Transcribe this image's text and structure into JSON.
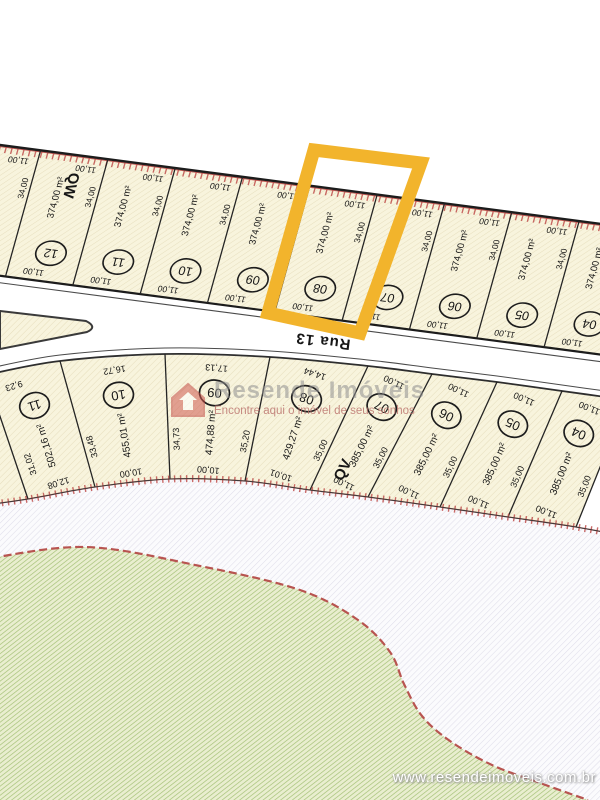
{
  "plan": {
    "street_label": "Rua 13",
    "highlight_color": "#F2B42C",
    "boundary_color": "#C0504D",
    "green_border_color": "#B85450",
    "quadra_top": {
      "label": "QW",
      "lots": [
        {
          "number": "13",
          "area": "374,00 m²",
          "side": "34,00",
          "front_top": "11,00",
          "front_bottom": "11,00",
          "highlighted": false
        },
        {
          "number": "12",
          "area": "374,00 m²",
          "side": "34,00",
          "front_top": "11,00",
          "front_bottom": "11,00",
          "highlighted": false
        },
        {
          "number": "11",
          "area": "374,00 m²",
          "side": "34,00",
          "front_top": "11,00",
          "front_bottom": "11,00",
          "highlighted": false
        },
        {
          "number": "10",
          "area": "374,00 m²",
          "side": "34,00",
          "front_top": "11,00",
          "front_bottom": "11,00",
          "highlighted": false
        },
        {
          "number": "09",
          "area": "374,00 m²",
          "side": "34,00",
          "front_top": "11,00",
          "front_bottom": "11,00",
          "highlighted": false
        },
        {
          "number": "08",
          "area": "374,00 m²",
          "side": "34,00",
          "front_top": "11,00",
          "front_bottom": "11,00",
          "highlighted": true
        },
        {
          "number": "07",
          "area": "374,00 m²",
          "side": "34,00",
          "front_top": "11,00",
          "front_bottom": "11,00",
          "highlighted": false
        },
        {
          "number": "06",
          "area": "374,00 m²",
          "side": "34,00",
          "front_top": "11,00",
          "front_bottom": "11,00",
          "highlighted": false
        },
        {
          "number": "05",
          "area": "374,00 m²",
          "side": "34,00",
          "front_top": "11,00",
          "front_bottom": "11,00",
          "highlighted": false
        },
        {
          "number": "04",
          "area": "374,00 m²",
          "side": "34,00",
          "front_top": "11,00",
          "front_bottom": "11,00",
          "highlighted": false
        }
      ]
    },
    "quadra_bottom": {
      "label": "QV",
      "lots": [
        {
          "number": "11",
          "area": "502,16 m²",
          "front_top": "9,23",
          "front_bottom": "12,08",
          "side_right": "33,48",
          "side_left": "31,02"
        },
        {
          "number": "10",
          "area": "455,01 m²",
          "front_top": "16,72",
          "front_bottom": "10,00",
          "side_right": "34,73"
        },
        {
          "number": "09",
          "area": "474,88 m²",
          "front_top": "17,13",
          "front_bottom": "10,00",
          "side_right": "35,20"
        },
        {
          "number": "08",
          "area": "429,27 m²",
          "front_top": "14,44",
          "front_bottom": "10,01",
          "side_right": "35,00"
        },
        {
          "number": "07",
          "area": "385,00 m²",
          "front_top": "11,00",
          "front_bottom": "11,00",
          "side_right": "35,00"
        },
        {
          "number": "06",
          "area": "385,00 m²",
          "front_top": "11,00",
          "front_bottom": "11,00",
          "side_right": "35,00"
        },
        {
          "number": "05",
          "area": "385,00 m²",
          "front_top": "11,00",
          "front_bottom": "11,00",
          "side_right": "35,00"
        },
        {
          "number": "04",
          "area": "385,00 m²",
          "front_top": "11,00",
          "front_bottom": "11,00",
          "side_right": "35,00"
        }
      ]
    }
  },
  "watermark": {
    "brand": "Resende Imóveis",
    "tagline": "Encontre aqui o imóvel de seus sonhos"
  },
  "footer_url": "www.resendeimoveis.com.br"
}
